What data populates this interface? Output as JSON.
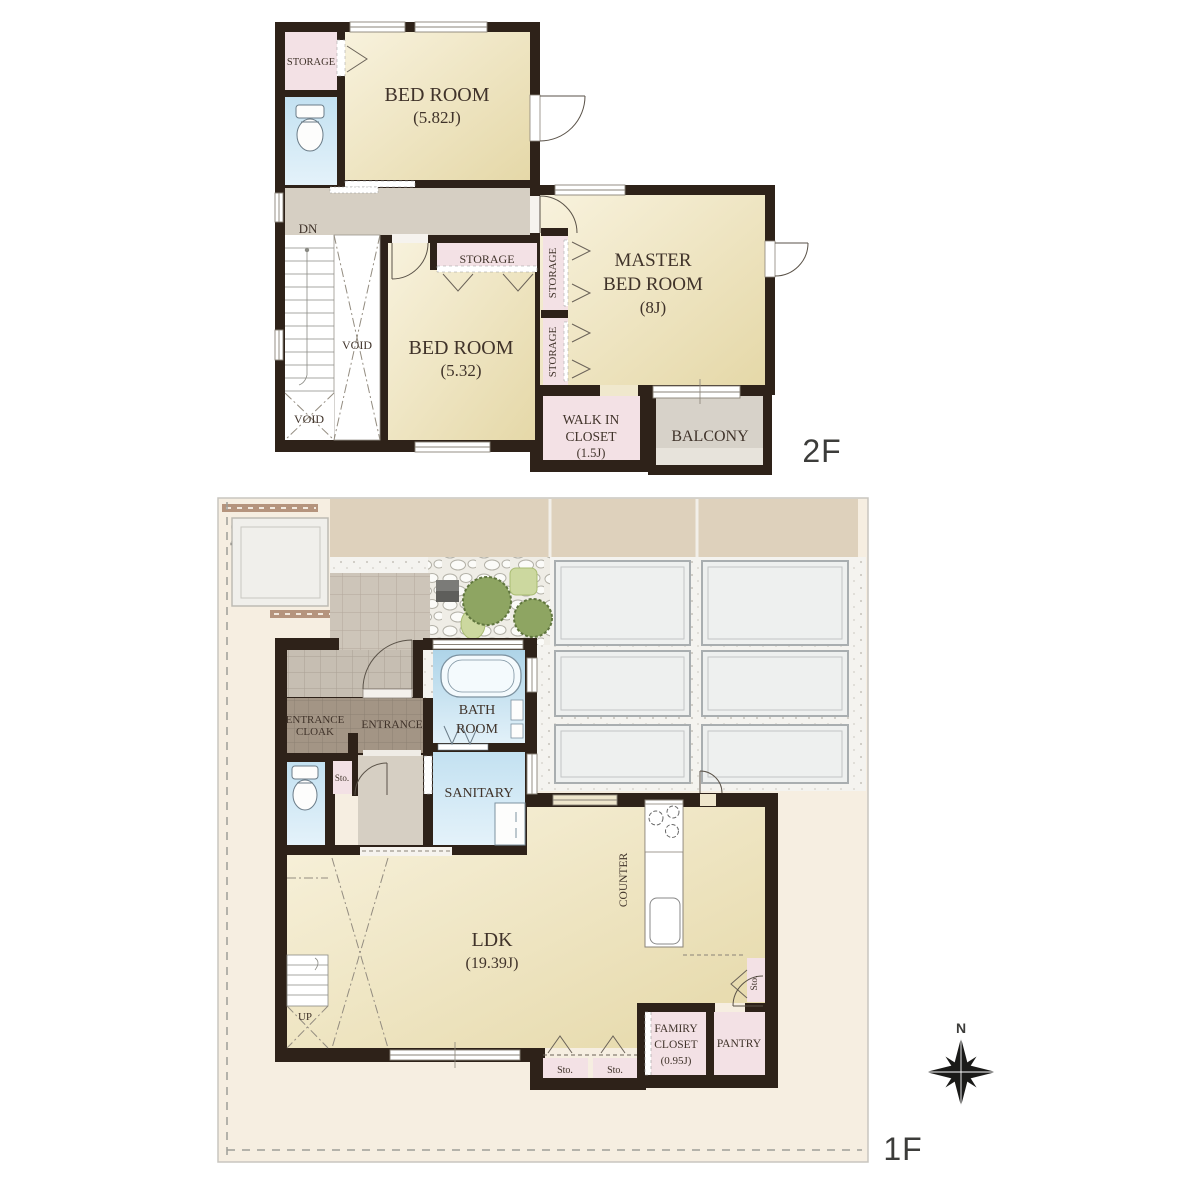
{
  "palette": {
    "wall": "#2e2219",
    "room_cream_light": "#f8f2dd",
    "room_cream_dark": "#e5d8a8",
    "storage_pink": "#f3e1e5",
    "water_blue_dark": "#b3d7ea",
    "water_blue_light": "#e0f0f8",
    "hall_gray": "#d6cfc3",
    "entrance_taupe": "#a39585",
    "porch_tile": "#c6beb2",
    "balcony_gray": "#d7d2c9",
    "road_tan": "#ded1bc",
    "site_cream": "#f6eee1",
    "gravel_white": "#f4f3ef",
    "parking_fill": "#eef0ef",
    "tree_green": "#8ea562",
    "shrub_green": "#ccd89f",
    "curb_brown": "#b5947d",
    "label_ink": "#40332a"
  },
  "floor2": {
    "floor_label": "2F",
    "storage_top_left": "STORAGE",
    "bedroom1_name": "BED ROOM",
    "bedroom1_size": "(5.82J)",
    "dn": "DN",
    "void_center": "VOID",
    "void_bottom": "VOID",
    "storage_mid": "STORAGE",
    "bedroom2_name": "BED ROOM",
    "bedroom2_size": "(5.32)",
    "storage_v1": "STORAGE",
    "storage_v2": "STORAGE",
    "master_line1": "MASTER",
    "master_line2": "BED ROOM",
    "master_size": "(8J)",
    "wic_line1": "WALK IN",
    "wic_line2": "CLOSET",
    "wic_size": "(1.5J)",
    "balcony": "BALCONY"
  },
  "floor1": {
    "floor_label": "1F",
    "utility_pole": "電柱",
    "entrance_cloak_line1": "ENTRANCE",
    "entrance_cloak_line2": "CLOAK",
    "entrance": "ENTRANCE",
    "bath_line1": "BATH",
    "bath_line2": "ROOM",
    "sanitary": "SANITARY",
    "sto_hall": "Sto.",
    "ldk_name": "LDK",
    "ldk_size": "(19.39J)",
    "up": "UP",
    "counter": "COUNTER",
    "sto_kitchen": "Sto.",
    "famiry_line1": "FAMIRY",
    "famiry_line2": "CLOSET",
    "famiry_size": "(0.95J)",
    "pantry": "PANTRY",
    "sto_bottom1": "Sto.",
    "sto_bottom2": "Sto."
  },
  "compass": {
    "north": "N"
  }
}
